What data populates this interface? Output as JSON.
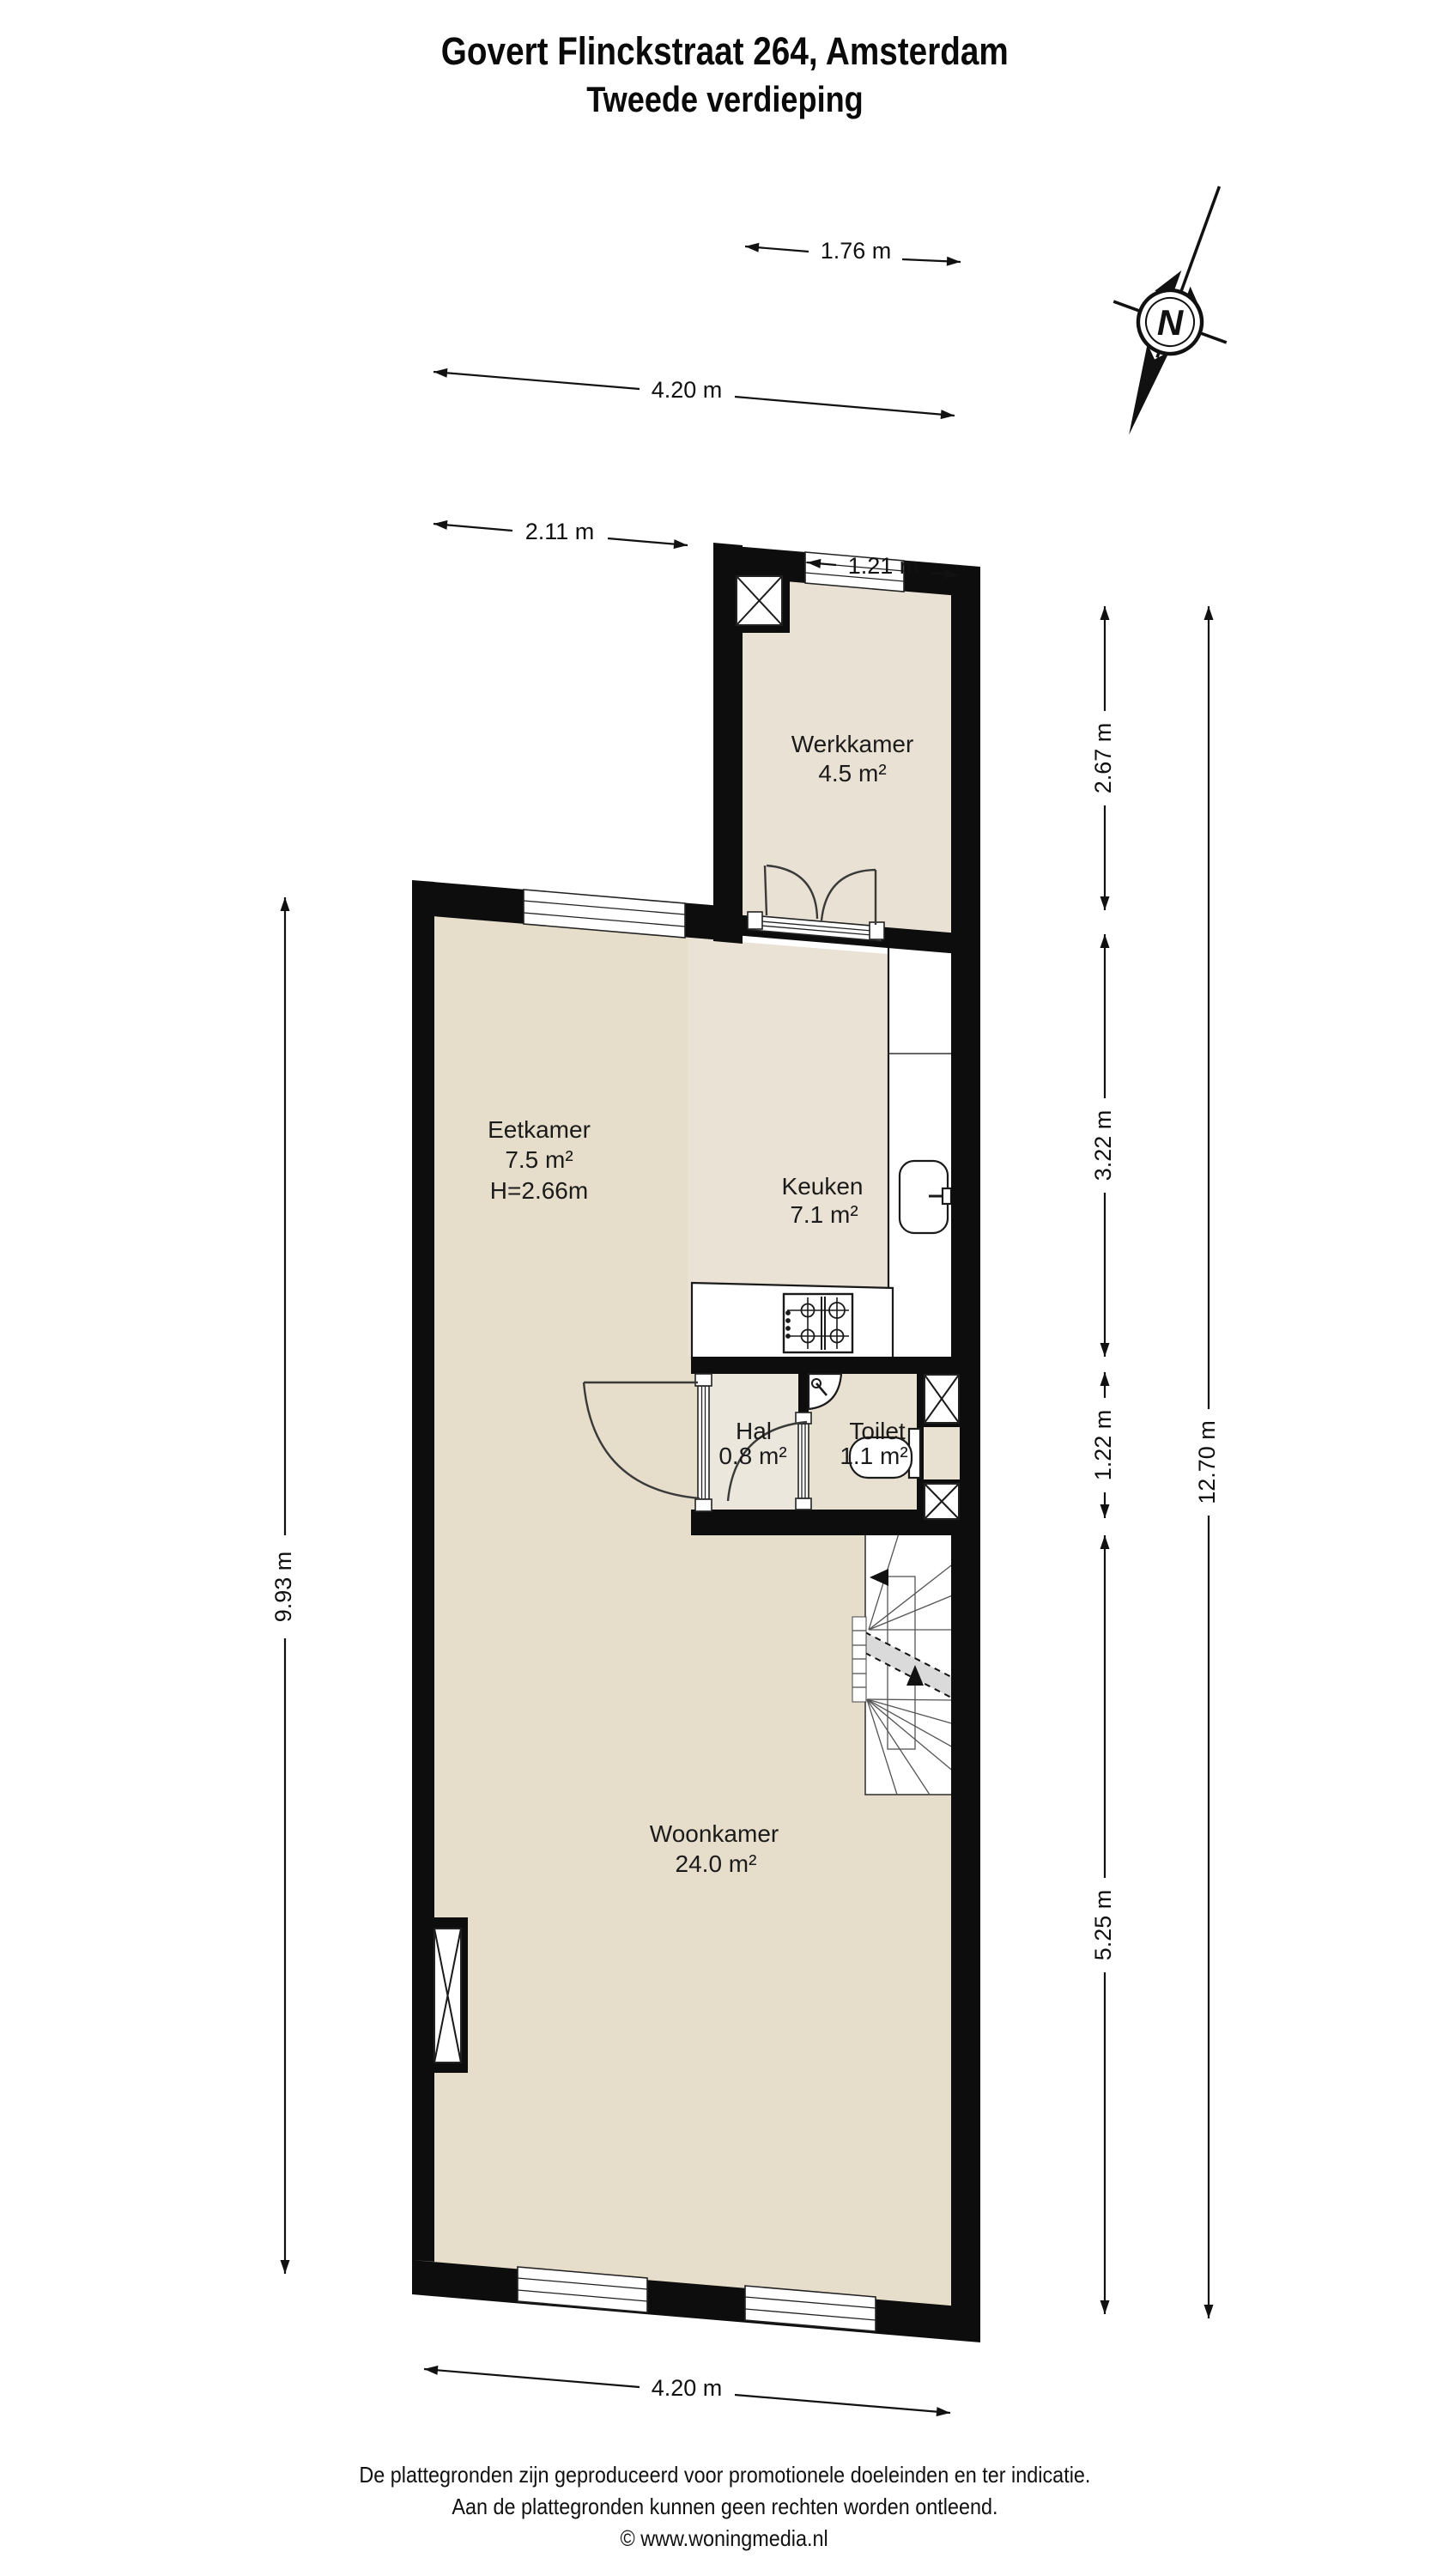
{
  "title": {
    "line1": "Govert Flinckstraat 264, Amsterdam",
    "line2": "Tweede verdieping"
  },
  "compass": {
    "north_label": "N"
  },
  "rooms": [
    {
      "name": "Werkkamer",
      "area": "4.5 m²"
    },
    {
      "name": "Eetkamer",
      "area": "7.5 m²",
      "height": "H=2.66m"
    },
    {
      "name": "Keuken",
      "area": "7.1 m²"
    },
    {
      "name": "Hal",
      "area": "0.8 m²"
    },
    {
      "name": "Toilet",
      "area": "1.1 m²"
    },
    {
      "name": "Woonkamer",
      "area": "24.0 m²"
    }
  ],
  "dimensions": {
    "top": [
      "1.76 m",
      "4.20 m",
      "2.11 m",
      "1.21 m"
    ],
    "right": [
      "2.67 m",
      "3.22 m",
      "1.22 m",
      "5.25 m"
    ],
    "overall_right": "12.70 m",
    "left": "9.93 m",
    "bottom": "4.20 m"
  },
  "footer": {
    "line1": "De plattegronden zijn geproduceerd voor promotionele doeleinden en ter indicatie.",
    "line2": "Aan de plattegronden kunnen geen rechten worden ontleend.",
    "line3": "© www.woningmedia.nl"
  },
  "colors": {
    "wall": "#0d0d0d",
    "floor_main": "#e6ddcb",
    "floor_keuken": "#eae2d4",
    "floor_werkkamer": "#e9e1d3",
    "floor_hal": "#ece7dd",
    "floor_toilet": "#e8e0d0",
    "stair_band": "#dadada"
  }
}
